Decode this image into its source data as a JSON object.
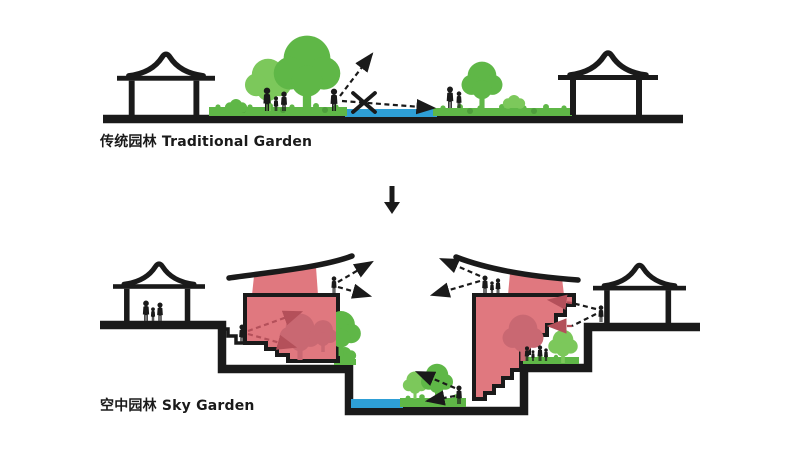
{
  "colors": {
    "ink": "#1a1a1a",
    "green": "#5FB747",
    "green_light": "#7CC85B",
    "green_dark": "#4E9E3C",
    "water": "#2E9FD6",
    "pink": "#E0787F",
    "pink_dark": "#C96872",
    "arrow_red": "#B4505A",
    "bg": "#ffffff"
  },
  "sections": [
    {
      "id": "traditional-garden",
      "label": "传统园林 Traditional Garden",
      "elements": [
        "pavilion",
        "lawn",
        "trees",
        "people",
        "pond",
        "sky-view-arrow",
        "blocked-view-x"
      ]
    },
    {
      "id": "sky-garden",
      "label": "空中园林 Sky Garden",
      "elements": [
        "pavilion",
        "terraced-pink-building",
        "curved-roof",
        "roof-garden-trees",
        "stairs",
        "people",
        "pond",
        "lawn",
        "view-arrows"
      ]
    }
  ],
  "transition": {
    "glyph": "↓",
    "meaning": "transforms into"
  }
}
